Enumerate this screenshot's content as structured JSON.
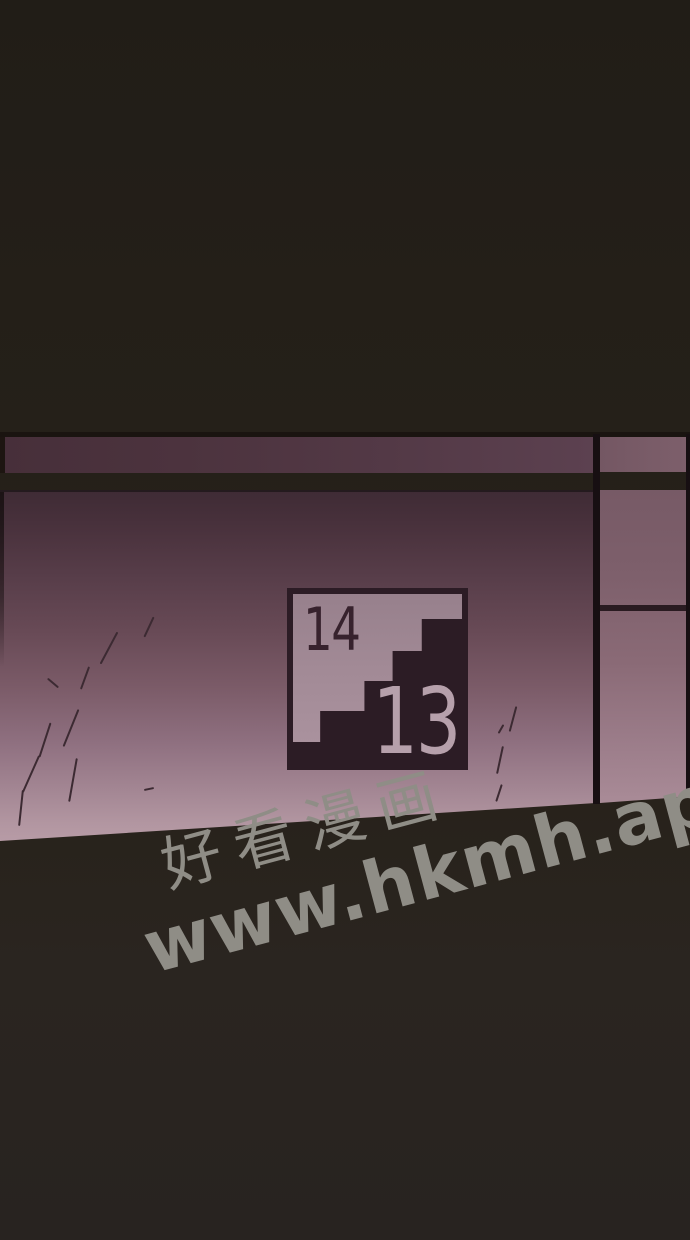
{
  "panel": {
    "type": "webtoon-comic-panel",
    "background_color": "#252019"
  },
  "wall": {
    "band_color_left": "#472f3a",
    "band_color_right": "#7d5f6b",
    "wall_top_color": "#3f2b35",
    "wall_bottom_color": "#b79ba6",
    "divider_color": "#170f12"
  },
  "sign": {
    "upper_floor": "14",
    "lower_floor": "13",
    "frame_color": "#2c1c25",
    "face_color": "#a28a96",
    "stairs_color": "#2c1c25",
    "upper_text_color": "#37222d",
    "lower_text_color": "#b6a0ab"
  },
  "watermark": {
    "line1": "好看漫画",
    "line2": "www.hkmh.app",
    "color": "#8f8d86",
    "rotation_deg": -15
  }
}
